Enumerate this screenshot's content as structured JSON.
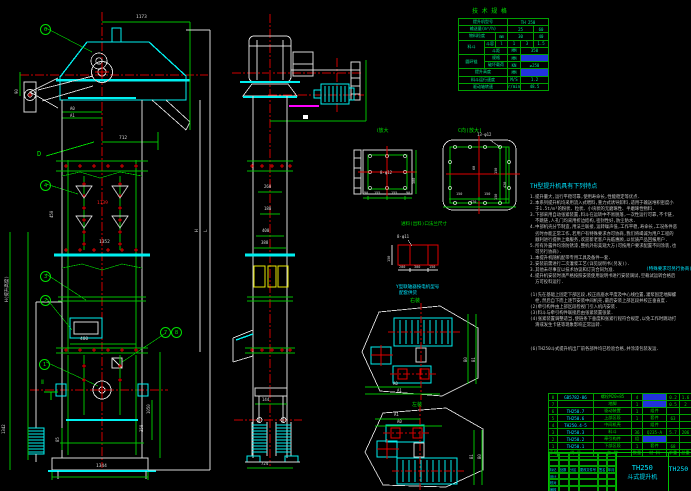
{
  "tech_table": {
    "title": "技 术 规 格",
    "cols": [
      26,
      11,
      12,
      13,
      13,
      15
    ],
    "rh": 7.2,
    "color": "#00e890",
    "rows": [
      [
        {
          "t": "提升机型号",
          "cs": 3
        },
        {
          "t": "TH 250",
          "cs": 3
        }
      ],
      [
        {
          "t": "输送量(m³/h)",
          "cs": 3
        },
        {
          "t": "25",
          "cs": 2
        },
        {
          "t": "60"
        }
      ],
      [
        {
          "t": "物料粒度",
          "cs": 2
        },
        {
          "t": "mm"
        },
        {
          "t": "30",
          "cs": 2
        },
        {
          "t": "40"
        }
      ],
      [
        {
          "t": "料斗",
          "rs": 2
        },
        {
          "t": "斗容"
        },
        {
          "t": "l"
        },
        {
          "t": "1"
        },
        {
          "t": "3"
        },
        {
          "t": "1.5"
        }
      ],
      [
        {
          "t": "斗距",
          "cs": 2
        },
        {
          "t": "MM"
        },
        {
          "t": "350",
          "cs": 2
        }
      ],
      [
        {
          "t": "圆环链",
          "rs": 2
        },
        {
          "t": "规格",
          "cs": 2
        },
        {
          "t": "MM"
        },
        {
          "t": "18×64",
          "cs": 2,
          "hl": true
        }
      ],
      [
        {
          "t": "破坏载荷",
          "cs": 2
        },
        {
          "t": "KN"
        },
        {
          "t": "≥250",
          "cs": 2
        }
      ],
      [
        {
          "t": "提升高度",
          "cs": 3
        },
        {
          "t": "MM"
        },
        {
          "t": "≤40",
          "cs": 2,
          "hl": true
        }
      ],
      [
        {
          "t": "料斗运行速度",
          "cs": 3
        },
        {
          "t": "M/S"
        },
        {
          "t": "1.2",
          "cs": 2
        }
      ],
      [
        {
          "t": "驱动轴转速",
          "cs": 3
        },
        {
          "t": "r/min"
        },
        {
          "t": "48.5",
          "cs": 2
        }
      ]
    ]
  },
  "bom": {
    "cols": [
      9,
      36,
      38,
      11,
      24,
      13,
      12
    ],
    "rh": 6.5,
    "color": "#00d800",
    "rows": [
      [
        {
          "t": "8"
        },
        {
          "t": "GB5782-86",
          "c": "cy"
        },
        {
          "t": "螺栓M20×85"
        },
        {
          "t": "4"
        },
        {
          "t": "M20",
          "hl": true
        },
        {
          "t": "0.2"
        },
        {
          "t": "1.6"
        }
      ],
      [
        {
          "t": "7"
        },
        {
          "t": ""
        },
        {
          "t": "地脚"
        },
        {
          "t": "1"
        },
        {
          "t": "L50",
          "hl": true
        },
        {
          "t": "0.5"
        },
        {
          "t": "2"
        }
      ],
      [
        {
          "t": "6"
        },
        {
          "t": "TH250.7",
          "c": "cy"
        },
        {
          "t": "驱动装置"
        },
        {
          "t": "1"
        },
        {
          "t": "组件"
        },
        {
          "t": ""
        },
        {
          "t": ""
        }
      ],
      [
        {
          "t": "5"
        },
        {
          "t": "TH250.6",
          "c": "cy"
        },
        {
          "t": "上部区段"
        },
        {
          "t": "1"
        },
        {
          "t": "套件"
        },
        {
          "t": "63"
        },
        {
          "t": ""
        }
      ],
      [
        {
          "t": "4"
        },
        {
          "t": "TH250.4·5",
          "c": "cy"
        },
        {
          "t": "中间机壳"
        },
        {
          "t": ""
        },
        {
          "t": "组件"
        },
        {
          "t": ""
        },
        {
          "t": ""
        }
      ],
      [
        {
          "t": "3"
        },
        {
          "t": "TH250.3",
          "c": "cy"
        },
        {
          "t": "料斗"
        },
        {
          "t": "36"
        },
        {
          "t": "Q235-A"
        },
        {
          "t": "5.7"
        },
        {
          "t": "206"
        }
      ],
      [
        {
          "t": "2"
        },
        {
          "t": "TH250.2",
          "c": "cy"
        },
        {
          "t": "牵引构件"
        },
        {
          "t": "组"
        },
        {
          "t": "套件",
          "hl": true
        },
        {
          "t": ""
        },
        {
          "t": ""
        }
      ],
      [
        {
          "t": "1"
        },
        {
          "t": "TH250.1",
          "c": "cy"
        },
        {
          "t": "下部区段"
        },
        {
          "t": "1"
        },
        {
          "t": "套件"
        },
        {
          "t": "68"
        },
        {
          "t": ""
        }
      ],
      [
        {
          "t": "序号"
        },
        {
          "t": "代 号"
        },
        {
          "t": "名 称"
        },
        {
          "t": "数量"
        },
        {
          "t": "材 料"
        },
        {
          "t": "单重"
        },
        {
          "t": "总重"
        }
      ]
    ]
  },
  "title_block": {
    "model": "TH250",
    "product": "斗式提升机",
    "drawing_no": "TH250",
    "rev_labels": [
      "标记",
      "处数",
      "分区",
      "更改文件号",
      "签名",
      "年月日"
    ],
    "sig_rows": [
      "设计",
      "校对",
      "审核"
    ]
  },
  "notes": {
    "heading": "TH型提升机具有下列特点",
    "lines": [
      {
        "t": "1.提升量大,运行平稳可靠,使用寿命长,性能稳定等优点."
      },
      {
        "t": "2.本系列提升机均采用流入式喂料,重力式诱导卸料,适用于输送堆积密度小"
      },
      {
        "t": "  于1.5t/m³的粉状、粒状、小块状的无磨琢性、半磨琢性物料."
      },
      {
        "t": "3.下部采用自动张紧装置,料斗在运转中不易脱落,一次性运行可靠,不卡链,"
      },
      {
        "t": "  不跳链,人孔门均采用折边结构,密封性好,防尘防水."
      },
      {
        "t": "4.中部机壳分节制造,用法兰联接,运转噪声低,工作平稳,寿命长,工况条件恶"
      },
      {
        "t": "  劣时亦能正常工作,若用户有特殊要求亦可协商,我们将竭诚为用户工程的"
      },
      {
        "t": "  顺利进行提供上乘服务,欢迎新老客户光临惠顾,以优质产品回报用户."
      },
      {
        "t": "5.所有外露件均涂防锈漆,整机外形美观大方(可按用户要求配置不同涂装,也"
      },
      {
        "t": "  可另行协商)."
      },
      {
        "t": "1.本提升机随机配带专用工具及备件一套."
      },
      {
        "t": "2.安装前需进行二次灌浆工艺(详见说明书(另发))."
      },
      {
        "t": "3.其他未尽事宜以技术协议和订货合同为准."
      },
      {
        "t": "4.提升机安装时须严格按照安装使用说明书进行安装调试,空载试运转合格后"
      },
      {
        "t": "  方可投料运行."
      },
      {
        "t": ""
      },
      {
        "t": "(1)先在基础上固定下部区段,校正底座水平度及中心线位置,灌浆固定地脚螺"
      },
      {
        "t": "  栓,然后自下而上逐节安装中间机壳,最后安装上部区段并校正垂直度."
      },
      {
        "t": "(2)牵引构件由上部区段检视门引入机内安装."
      },
      {
        "t": "(3)料斗与牵引构件联接后由张紧装置张紧."
      },
      {
        "t": "(4)张紧装置调整适当,使链条下垂度和张紧行程符合规定,以免工作时跳动打"
      },
      {
        "t": "  滑或发生卡链等现象影响正常运转."
      },
      {
        "t": ""
      },
      {
        "t": ""
      },
      {
        "t": ""
      },
      {
        "t": "(6)TH250斗式提升机出厂前各部件均已检验合格,并涂漆包装发运."
      }
    ]
  },
  "balloons": [
    {
      "n": "6",
      "x": 40,
      "y": 24
    },
    {
      "n": "4",
      "x": 40,
      "y": 180
    },
    {
      "n": "3",
      "x": 40,
      "y": 271
    },
    {
      "n": "2",
      "x": 40,
      "y": 295
    },
    {
      "n": "1",
      "x": 39,
      "y": 359
    },
    {
      "n": "7",
      "x": 160,
      "y": 327
    },
    {
      "n": "8",
      "x": 171,
      "y": 327
    }
  ],
  "labels": [
    {
      "n": "tech-table-title",
      "t": "技 术 规 格",
      "x": 472,
      "y": 9,
      "c": "#00e000",
      "s": 6
    },
    {
      "n": "dim-1173",
      "t": "1173",
      "x": 136,
      "y": 16,
      "c": "#d8d8d8",
      "s": 4.5
    },
    {
      "n": "dim-712",
      "t": "712",
      "x": 119,
      "y": 137,
      "c": "#d8d8d8",
      "s": 4.5
    },
    {
      "n": "dim-a0-front",
      "t": "A0",
      "x": 70,
      "y": 107,
      "c": "#d8d8d8",
      "s": 4
    },
    {
      "n": "dim-a1-front",
      "t": "A1",
      "x": 70,
      "y": 114,
      "c": "#d8d8d8",
      "s": 4
    },
    {
      "n": "dim-90",
      "t": "90",
      "x": 15,
      "y": 94,
      "r": -90,
      "c": "#d8d8d8",
      "s": 4
    },
    {
      "n": "section-d",
      "t": "D",
      "x": 37,
      "y": 151,
      "c": "#00e000",
      "s": 7
    },
    {
      "n": "dim-450",
      "t": "450",
      "x": 50,
      "y": 218,
      "r": -90,
      "c": "#d8d8d8",
      "s": 4
    },
    {
      "n": "dim-1139",
      "t": "1139",
      "x": 97,
      "y": 202,
      "c": "#ff2020",
      "s": 4.5
    },
    {
      "n": "dim-1352",
      "t": "1352",
      "x": 99,
      "y": 241,
      "c": "#d8d8d8",
      "s": 4.5
    },
    {
      "n": "dim-lift-height",
      "t": "H(提升高度)",
      "x": 6,
      "y": 302,
      "r": -90,
      "c": "#d8d8d8",
      "s": 4.5
    },
    {
      "n": "dim-h-letter",
      "t": "H",
      "x": 196,
      "y": 232,
      "r": -90,
      "c": "#d8d8d8",
      "s": 4.5
    },
    {
      "n": "dim-l-letter",
      "t": "L",
      "x": 205,
      "y": 232,
      "r": -90,
      "c": "#d8d8d8",
      "s": 4.5
    },
    {
      "n": "dim-400-door",
      "t": "400",
      "x": 80,
      "y": 338,
      "c": "#d8d8d8",
      "s": 4.5
    },
    {
      "n": "section-ii",
      "t": "Ⅱ",
      "x": 41,
      "y": 380,
      "c": "#00e000",
      "s": 6
    },
    {
      "n": "dim-1050",
      "t": "1050",
      "x": 147,
      "y": 414,
      "r": -90,
      "c": "#d8d8d8",
      "s": 4
    },
    {
      "n": "dim-350",
      "t": "350",
      "x": 140,
      "y": 432,
      "r": -90,
      "c": "#d8d8d8",
      "s": 4
    },
    {
      "n": "dim-1342",
      "t": "1342",
      "x": 2,
      "y": 434,
      "r": -90,
      "c": "#d8d8d8",
      "s": 4
    },
    {
      "n": "dim-85",
      "t": "85",
      "x": 56,
      "y": 442,
      "r": -90,
      "c": "#d8d8d8",
      "s": 4
    },
    {
      "n": "dim-1344",
      "t": "1344",
      "x": 96,
      "y": 465,
      "c": "#d8d8d8",
      "s": 4.5
    },
    {
      "n": "dim-260",
      "t": "260",
      "x": 264,
      "y": 185,
      "c": "#d8d8d8",
      "s": 4
    },
    {
      "n": "dim-180",
      "t": "180",
      "x": 264,
      "y": 207,
      "c": "#d8d8d8",
      "s": 4
    },
    {
      "n": "dim-400-side",
      "t": "400",
      "x": 262,
      "y": 229,
      "c": "#d8d8d8",
      "s": 4
    },
    {
      "n": "dim-388",
      "t": "388",
      "x": 261,
      "y": 241,
      "c": "#d8d8d8",
      "s": 4
    },
    {
      "n": "dim-144",
      "t": "144",
      "x": 262,
      "y": 398,
      "c": "#d8d8d8",
      "s": 4
    },
    {
      "n": "dim-724",
      "t": "724",
      "x": 261,
      "y": 462,
      "c": "#d8d8d8",
      "s": 4
    },
    {
      "n": "detail-i-title",
      "t": "Ⅰ放大",
      "x": 377,
      "y": 129,
      "c": "#00e000",
      "s": 5
    },
    {
      "n": "dim-8-d12",
      "t": "8-φ12",
      "x": 380,
      "y": 171,
      "c": "#d8d8d8",
      "s": 4
    },
    {
      "n": "dim-90a",
      "t": "90",
      "x": 364,
      "y": 192,
      "c": "#d8d8d8",
      "s": 3.5
    },
    {
      "n": "dim-155a",
      "t": "155",
      "x": 374,
      "y": 192,
      "c": "#d8d8d8",
      "s": 3.5
    },
    {
      "n": "dim-155b",
      "t": "155",
      "x": 391,
      "y": 192,
      "c": "#d8d8d8",
      "s": 3.5
    },
    {
      "n": "dim-90b",
      "t": "90",
      "x": 406,
      "y": 192,
      "c": "#d8d8d8",
      "s": 3.5
    },
    {
      "n": "dim-300-rot",
      "t": "300",
      "x": 413,
      "y": 184,
      "r": -90,
      "c": "#d8d8d8",
      "s": 3.5
    },
    {
      "n": "detail-c-title",
      "t": "C向(放大)",
      "x": 458,
      "y": 129,
      "c": "#00e000",
      "s": 5
    },
    {
      "n": "dim-13-d12",
      "t": "13-φ12",
      "x": 477,
      "y": 133,
      "c": "#d8d8d8",
      "s": 4
    },
    {
      "n": "dim-150a",
      "t": "150",
      "x": 456,
      "y": 193,
      "c": "#d8d8d8",
      "s": 3.5
    },
    {
      "n": "dim-150b",
      "t": "150",
      "x": 484,
      "y": 193,
      "c": "#d8d8d8",
      "s": 3.5
    },
    {
      "n": "dim-470",
      "t": "470",
      "x": 470,
      "y": 201,
      "c": "#d8d8d8",
      "s": 3.5
    },
    {
      "n": "dim-150c",
      "t": "150",
      "x": 495,
      "y": 174,
      "r": -90,
      "c": "#d8d8d8",
      "s": 3.5
    },
    {
      "n": "dim-150d",
      "t": "150",
      "x": 495,
      "y": 200,
      "r": -90,
      "c": "#d8d8d8",
      "s": 3.5
    },
    {
      "n": "dim-420",
      "t": "420",
      "x": 504,
      "y": 188,
      "r": -90,
      "c": "#d8d8d8",
      "s": 3.5
    },
    {
      "n": "dim-60",
      "t": "60",
      "x": 473,
      "y": 170,
      "r": -90,
      "c": "#d8d8d8",
      "s": 3.5
    },
    {
      "n": "flange-note",
      "t": "进料(出料)口法兰尺寸",
      "x": 401,
      "y": 223,
      "c": "#00e000",
      "s": 4.5
    },
    {
      "n": "dim-8-d11",
      "t": "8-φ11",
      "x": 397,
      "y": 235,
      "c": "#d8d8d8",
      "s": 4
    },
    {
      "n": "dim-200",
      "t": "200",
      "x": 399,
      "y": 266,
      "c": "#d8d8d8",
      "s": 3.5
    },
    {
      "n": "dim-300b",
      "t": "300",
      "x": 414,
      "y": 266,
      "c": "#d8d8d8",
      "s": 3.5
    },
    {
      "n": "dim-150e",
      "t": "150",
      "x": 429,
      "y": 266,
      "c": "#d8d8d8",
      "s": 3.5
    },
    {
      "n": "dim-150f",
      "t": "150",
      "x": 388,
      "y": 262,
      "r": -90,
      "c": "#d8d8d8",
      "s": 3.5
    },
    {
      "n": "coupling-note-1",
      "t": "Y型联轴器按电机型号",
      "x": 396,
      "y": 286,
      "c": "#00e5ff",
      "s": 4.5
    },
    {
      "n": "coupling-note-2",
      "t": "配套供货",
      "x": 399,
      "y": 292,
      "c": "#00e5ff",
      "s": 4.5
    },
    {
      "n": "plan-right-title",
      "t": "右装",
      "x": 410,
      "y": 299,
      "c": "#00e000",
      "s": 5
    },
    {
      "n": "plan-left-title",
      "t": "左装",
      "x": 412,
      "y": 403,
      "c": "#00e000",
      "s": 5
    },
    {
      "n": "dim-a0-planr",
      "t": "A0",
      "x": 393,
      "y": 382,
      "c": "#d8d8d8",
      "s": 4
    },
    {
      "n": "dim-a1-planr",
      "t": "A1",
      "x": 397,
      "y": 389,
      "c": "#d8d8d8",
      "s": 4
    },
    {
      "n": "dim-b0-planr",
      "t": "B0",
      "x": 464,
      "y": 362,
      "r": -90,
      "c": "#d8d8d8",
      "s": 4
    },
    {
      "n": "dim-b1-planr",
      "t": "B1",
      "x": 472,
      "y": 362,
      "r": -90,
      "c": "#d8d8d8",
      "s": 4
    },
    {
      "n": "dim-a1-planl",
      "t": "A1",
      "x": 394,
      "y": 413,
      "c": "#d8d8d8",
      "s": 4
    },
    {
      "n": "dim-a0-planl",
      "t": "A0",
      "x": 397,
      "y": 420,
      "c": "#d8d8d8",
      "s": 4
    },
    {
      "n": "dim-b1-planl",
      "t": "B1",
      "x": 470,
      "y": 459,
      "r": -90,
      "c": "#d8d8d8",
      "s": 4
    },
    {
      "n": "dim-b0-planl",
      "t": "B0",
      "x": 478,
      "y": 459,
      "r": -90,
      "c": "#d8d8d8",
      "s": 4
    },
    {
      "n": "note-special-order",
      "t": "(特殊要求可另行协商)",
      "x": 646,
      "y": 268,
      "c": "#00e5ff",
      "s": 4.5
    }
  ]
}
